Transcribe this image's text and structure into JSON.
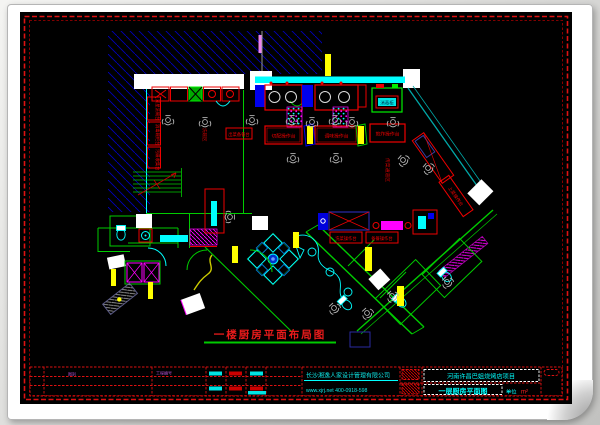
{
  "title": {
    "text": "一楼厨房平面布局图",
    "color": "#ea1b1b",
    "underline_color": "#00ca00"
  },
  "plan": {
    "labels": {
      "wash1": "双星洗碗台",
      "wash2": "消毒碗柜台",
      "wash3": "污碟收集台",
      "washzone": "洗碗区",
      "outlet": "出菜备餐台",
      "mid1": "切配操作台",
      "mid2": "调味操作台",
      "mid3": "煎炸操作台",
      "diag": "上菜操作台",
      "prep1": "洗菜操作台",
      "prep2": "备餐操作台",
      "corridor": "传菜通道区",
      "sterilizer": "消毒柜"
    }
  },
  "titleblock": {
    "company": "长沙湘逸人家设计管理有限公司",
    "contact": "www.xjrj.net   400-0918-598",
    "project": "河南许昌巴姐烧烤店项目",
    "drawing": "一层厨房平面图",
    "unit_label": "单位",
    "unit_value": "m²",
    "note_left": "图别",
    "note_mid": "工程编号"
  },
  "colors": {
    "canvas": "#000000",
    "border": "#dd1111",
    "wall_cyan": "#00ffff",
    "wall_green": "#00cc00",
    "hatch_blue": "#0000bb",
    "equipment_red": "#ee0000",
    "accent_yellow": "#ffff00",
    "accent_magenta": "#ff00ff",
    "text_cyan": "#0ee8e8"
  }
}
